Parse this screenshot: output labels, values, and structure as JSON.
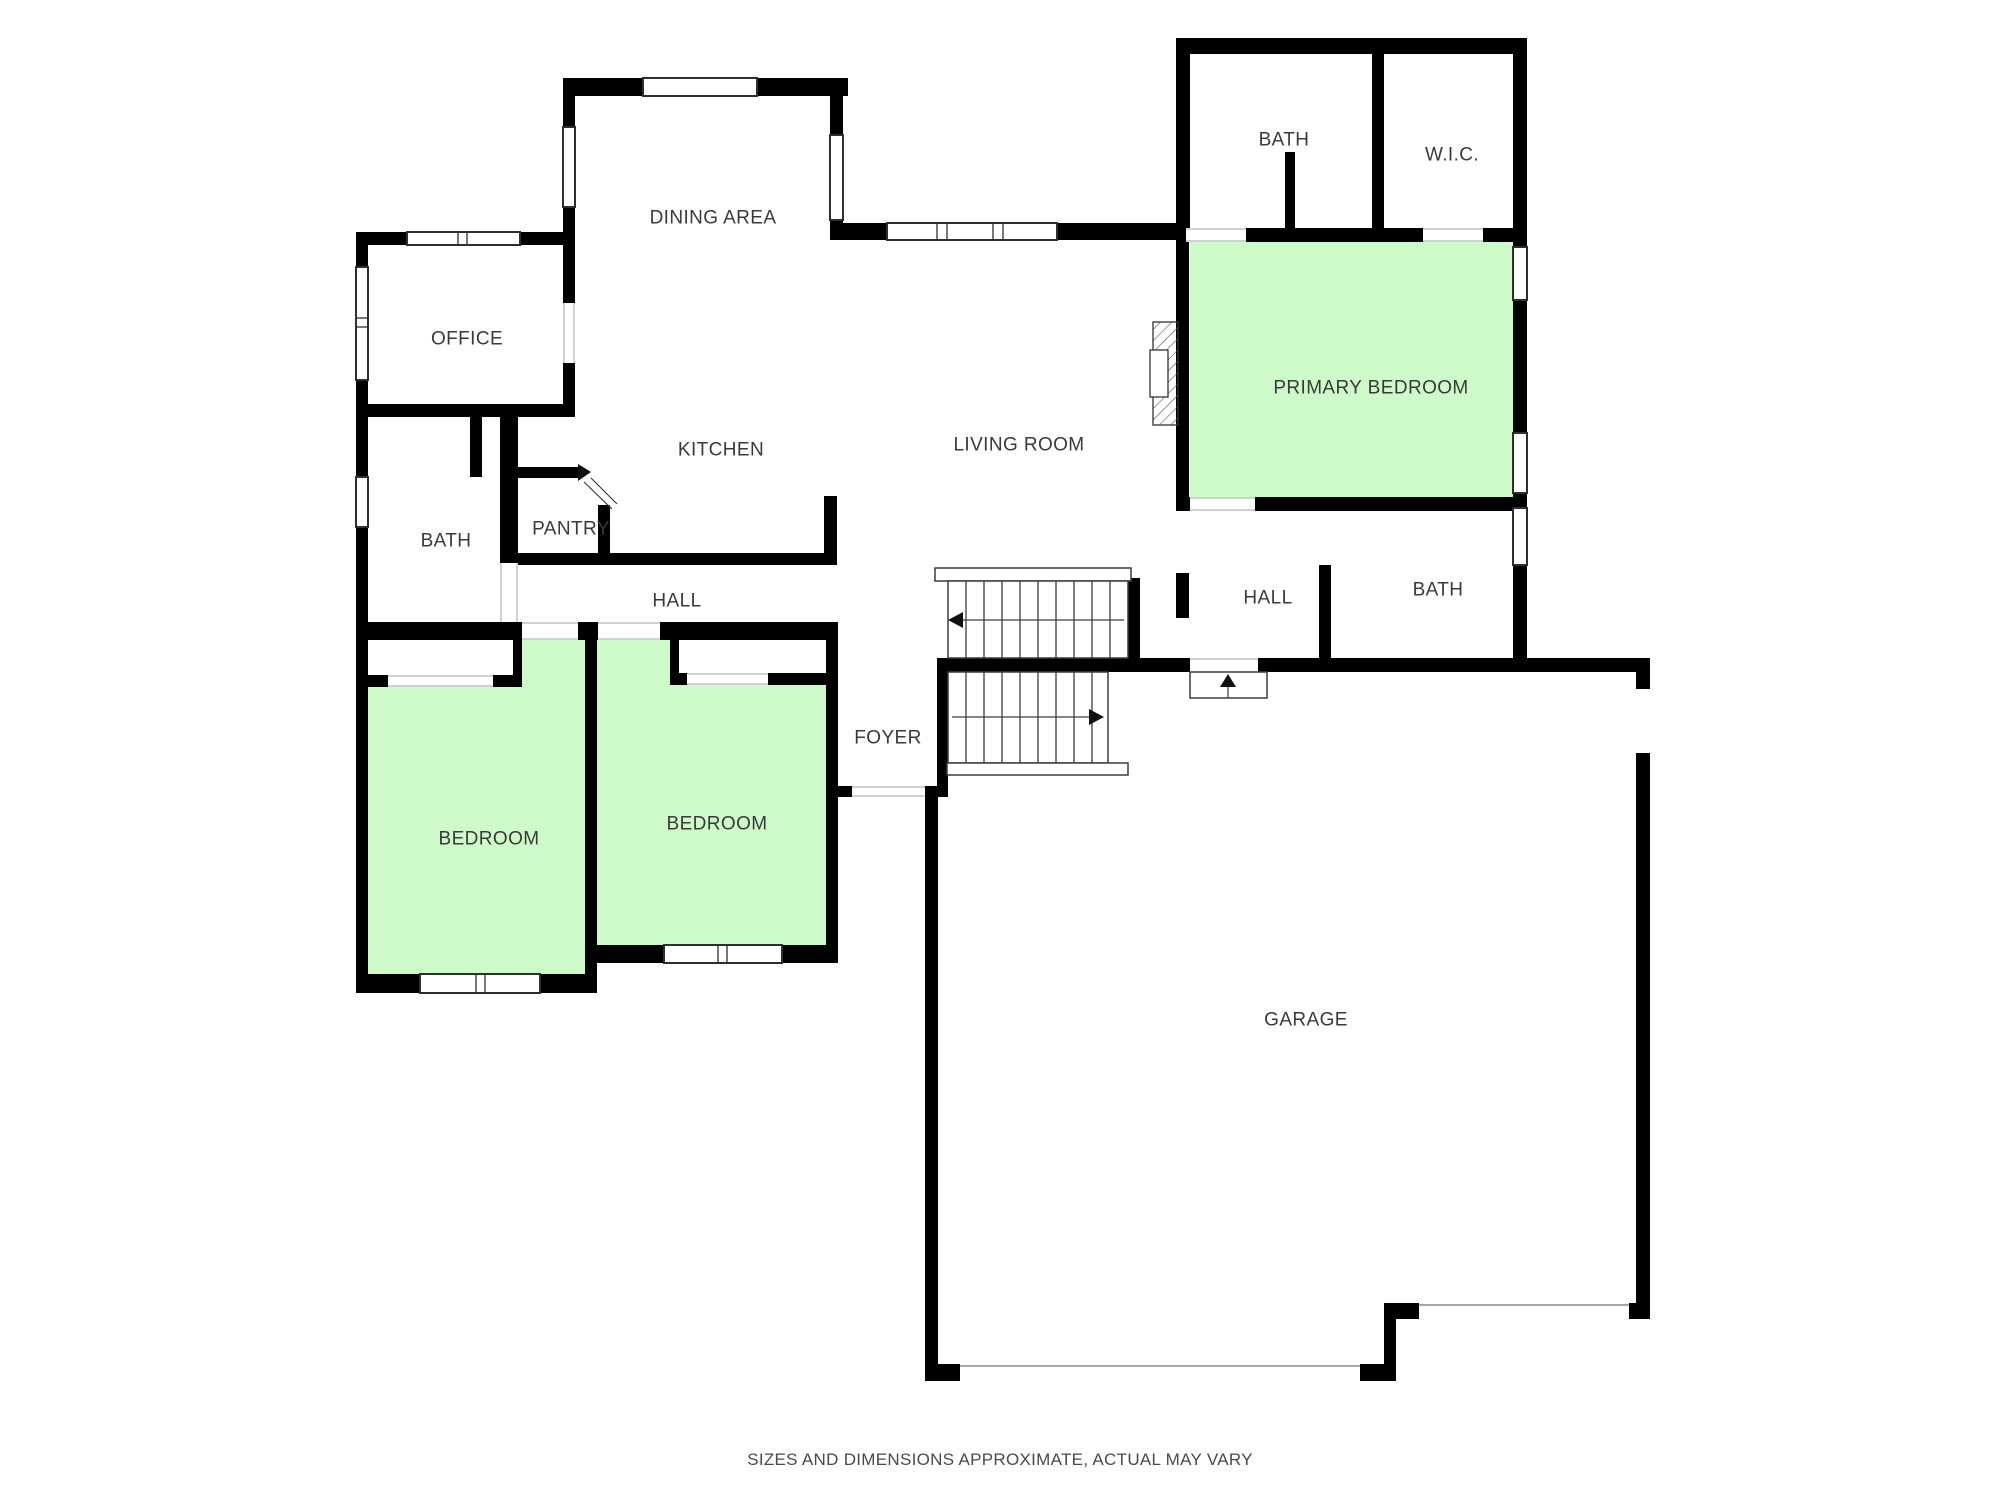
{
  "colors": {
    "wall": "#000000",
    "room_highlight": "#cdfac8",
    "label_text": "#3a3a3a",
    "line": "#2e2e2e",
    "disclaimer_text": "#4a4a4a"
  },
  "rooms": {
    "dining_area": "DINING AREA",
    "office": "OFFICE",
    "kitchen": "KITCHEN",
    "living_room": "LIVING ROOM",
    "bath_top": "BATH",
    "wic": "W.I.C.",
    "primary_bedroom": "PRIMARY BEDROOM",
    "bath_left": "BATH",
    "pantry": "PANTRY",
    "hall_left": "HALL",
    "hall_right": "HALL",
    "bath_right": "BATH",
    "foyer": "FOYER",
    "bedroom_left": "BEDROOM",
    "bedroom_right": "BEDROOM",
    "garage": "GARAGE"
  },
  "stair_icons": {
    "upper_flight_arrow": "arrow-left-icon",
    "lower_flight_arrow": "arrow-right-icon",
    "entry_step_arrow": "arrow-up-icon"
  },
  "disclaimer": "SIZES AND DIMENSIONS APPROXIMATE, ACTUAL MAY VARY"
}
